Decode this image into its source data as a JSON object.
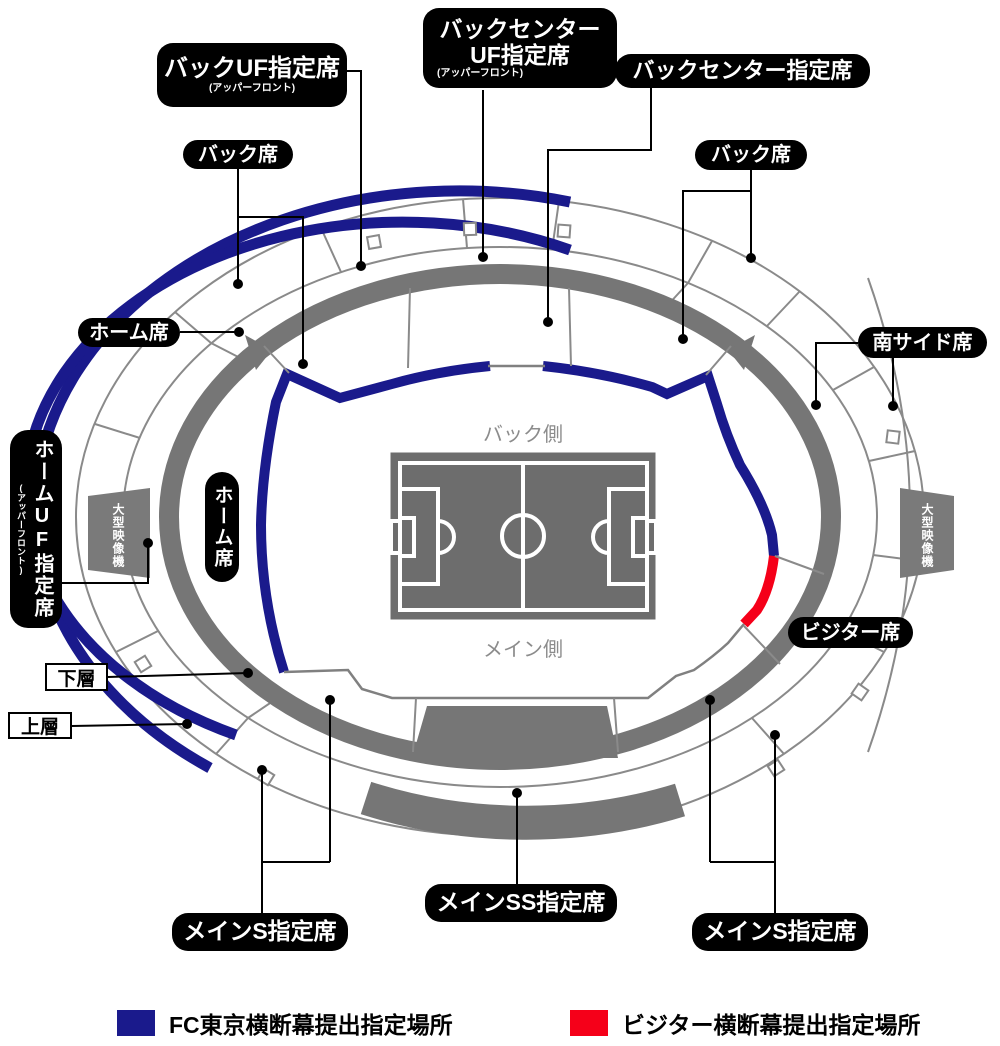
{
  "labels": {
    "back_uf": {
      "text": "バックUF指定席",
      "sub": "(アッパーフロント)"
    },
    "back_center_uf": {
      "text": "バックセンターUF指定席",
      "sub": "(アッパーフロント)"
    },
    "back_center": {
      "text": "バックセンター指定席"
    },
    "back_left": {
      "text": "バック席"
    },
    "back_right": {
      "text": "バック席"
    },
    "home_left": {
      "text": "ホーム席"
    },
    "home_vertical": {
      "text": "ホーム席"
    },
    "home_uf": {
      "text": "ホームUF指定席",
      "sub": "(アッパーフロント)"
    },
    "south_side": {
      "text": "南サイド席"
    },
    "visitor": {
      "text": "ビジター席"
    },
    "main_s_left": {
      "text": "メインS指定席"
    },
    "main_ss": {
      "text": "メインSS指定席"
    },
    "main_s_right": {
      "text": "メインS指定席"
    }
  },
  "tiers": {
    "lower": "下層",
    "upper": "上層"
  },
  "screens": {
    "left": "大型映像機",
    "right": "大型映像機"
  },
  "pitch_sides": {
    "back": "バック側",
    "main": "メイン側"
  },
  "legend": {
    "home": {
      "label": "FC東京横断幕提出指定場所",
      "color": "#1a1a8c"
    },
    "visitor": {
      "label": "ビジター横断幕提出指定場所",
      "color": "#f50019"
    }
  },
  "colors": {
    "fc_tokyo_blue": "#1a1a8c",
    "visitor_red": "#f50019",
    "stand_gray": "#767676",
    "outline_gray": "#8a8a8a",
    "field_gray": "#6d6d6d"
  }
}
